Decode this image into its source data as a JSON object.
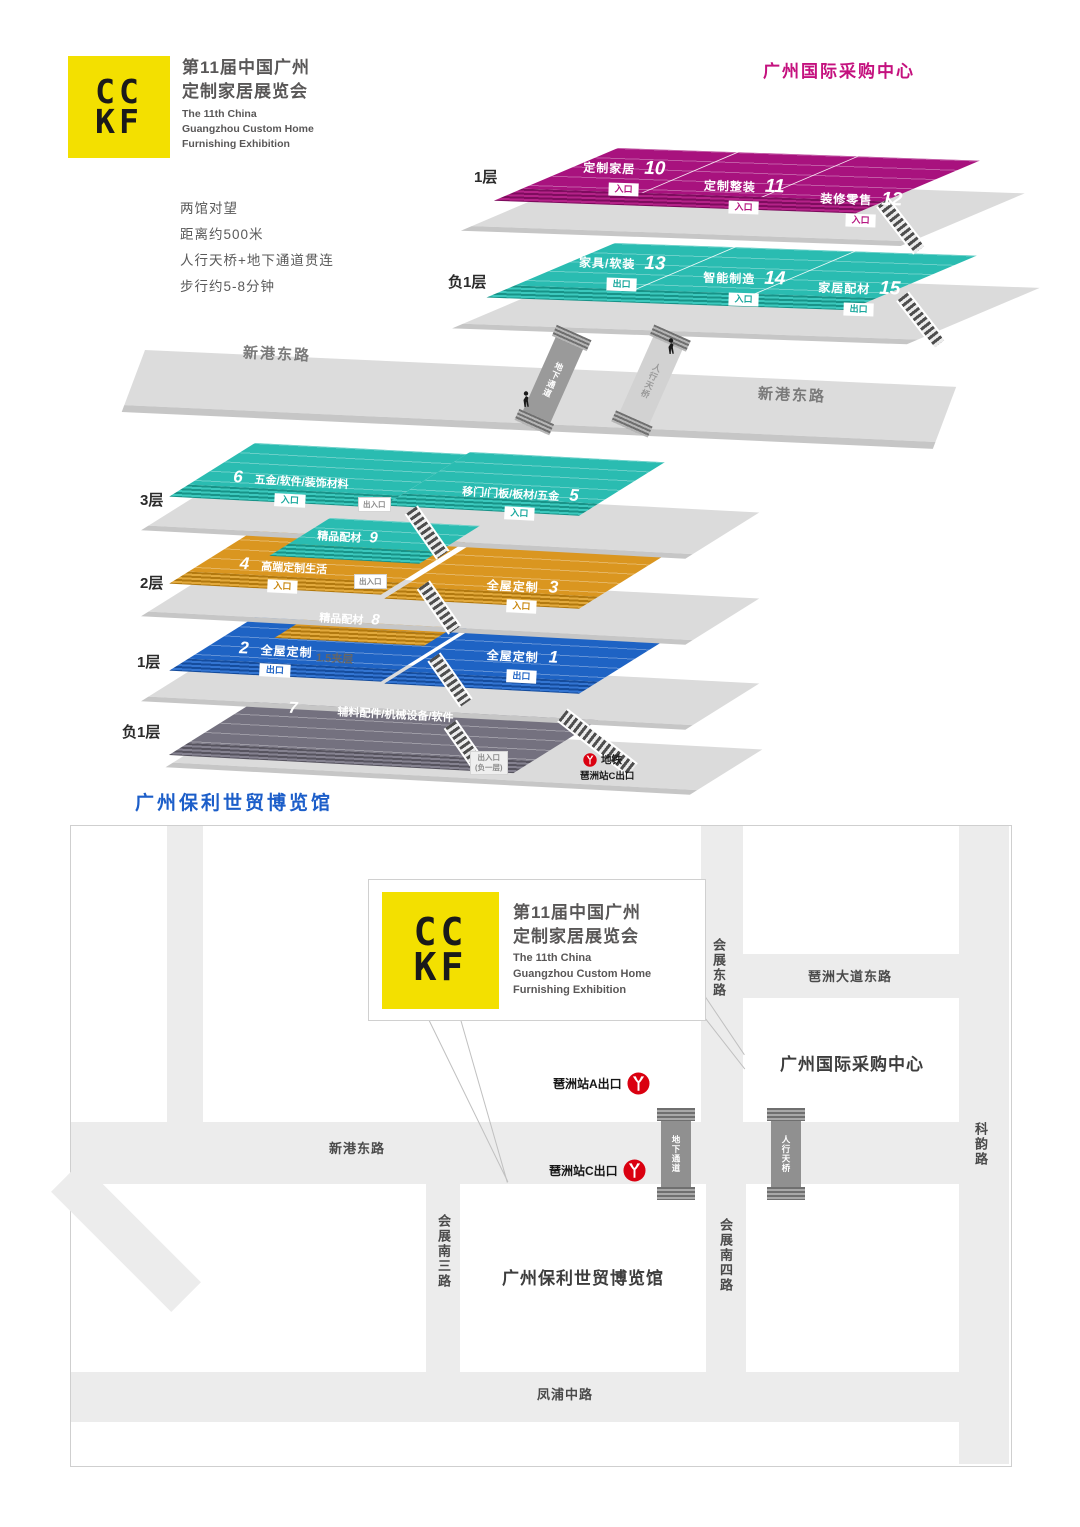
{
  "logo": {
    "mark_top": "CC",
    "mark_bottom": "KF",
    "cn_line1": "第11届中国广州",
    "cn_line2": "定制家居展览会",
    "en_line1": "The 11th China",
    "en_line2": "Guangzhou Custom Home",
    "en_line3": "Furnishing Exhibition"
  },
  "info_lines": [
    "两馆对望",
    "距离约500米",
    "人行天桥+地下通道贯连",
    "步行约5-8分钟"
  ],
  "purchasing_center": {
    "title": "广州国际采购中心",
    "floor_1": {
      "label": "1层"
    },
    "floor_b1": {
      "label": "负1层"
    },
    "halls": [
      {
        "no": "10",
        "name": "定制家居",
        "badge": "入口"
      },
      {
        "no": "11",
        "name": "定制整装",
        "badge": "入口"
      },
      {
        "no": "12",
        "name": "装修零售",
        "badge": "入口"
      },
      {
        "no": "13",
        "name": "家具/软装",
        "badge": "出口"
      },
      {
        "no": "14",
        "name": "智能制造",
        "badge": "入口"
      },
      {
        "no": "15",
        "name": "家居配材",
        "badge": "出口"
      }
    ]
  },
  "road": {
    "label_left": "新港东路",
    "label_right": "新港东路",
    "underpass": "地下通道",
    "footbridge": "人行天桥"
  },
  "poly": {
    "title": "广州保利世贸博览馆",
    "floors": {
      "f3": "3层",
      "f2": "2层",
      "f1": "1层",
      "b1": "负1层"
    },
    "halls": [
      {
        "no": "6",
        "name": "五金/软件/装饰材料",
        "badge": "入口"
      },
      {
        "no": "5",
        "name": "移门/门板/板材/五金",
        "badge": "入口"
      },
      {
        "no": "9",
        "name": "精品配材"
      },
      {
        "no": "4",
        "name": "高端定制生活",
        "badge": "入口"
      },
      {
        "no": "3",
        "name": "全屋定制",
        "badge": "入口"
      },
      {
        "no": "8",
        "name": "精品配材"
      },
      {
        "no": "2",
        "name": "全屋定制",
        "badge": "出口"
      },
      {
        "no": "1",
        "name": "全屋定制",
        "badge": "出口"
      },
      {
        "no": "7",
        "name": "辅料配件/机械设备/软件"
      }
    ],
    "access_badge": "出入口",
    "mezzanine": "1.5夹层",
    "b1_exit_badge_line1": "出入口",
    "b1_exit_badge_line2": "(负一层)",
    "metro_line1": "地铁",
    "metro_line2": "琶洲站C出口"
  },
  "map": {
    "roads": {
      "xingang_east": "新港东路",
      "pazhou_avenue_east": "琶洲大道东路",
      "huizhan_east": "会展东路",
      "keyun": "科韵路",
      "huizhan_south_3": "会展南三路",
      "huizhan_south_4": "会展南四路",
      "fengpu_middle": "凤浦中路"
    },
    "buildings": {
      "purchasing_center": "广州国际采购中心",
      "poly_expo": "广州保利世贸博览馆"
    },
    "stations": {
      "exit_a": "琶洲站A出口",
      "exit_c": "琶洲站C出口"
    },
    "crossings": {
      "underpass": "地下通道",
      "footbridge": "人行天桥"
    }
  },
  "colors": {
    "logo_yellow": "#F3E000",
    "magenta": "#A8127E",
    "magenta_accent": "#C4117E",
    "teal": "#2ABCB1",
    "orange": "#DA9620",
    "blue": "#1E63C4",
    "hall_gray": "#74717F",
    "poly_title_blue": "#1C5EC9",
    "metro_red": "#DA0010"
  }
}
